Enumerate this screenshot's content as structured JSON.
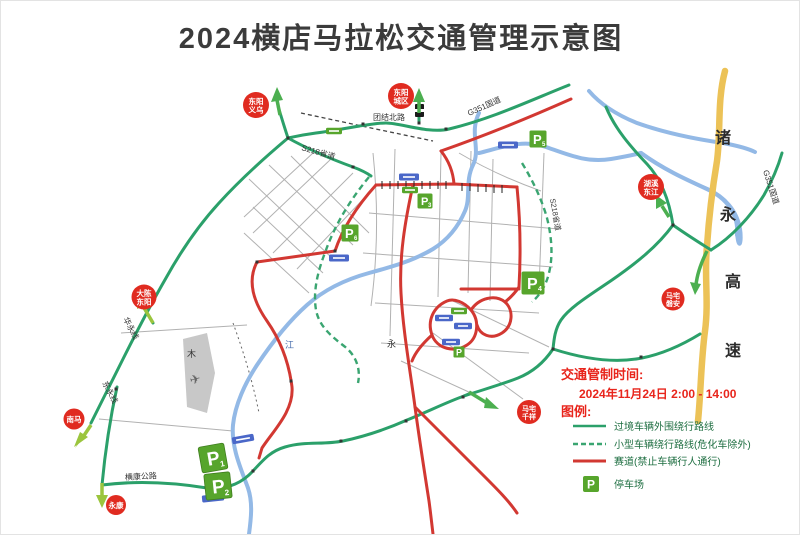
{
  "title": "2024横店马拉松交通管理示意图",
  "colors": {
    "bypass_green": "#2ba06a",
    "race_red": "#d23832",
    "river_blue": "#93b9e6",
    "expressway_yellow": "#ecc257",
    "badge_red": "#e02b20",
    "parking_green": "#57a52c",
    "legend_red": "#e8251c",
    "arrow_green": "#4caf50",
    "arrow_yellow_green": "#9bc53d"
  },
  "legend": {
    "control_time_label": "交通管制时间:",
    "control_time_value": "2024年11月24日 2:00 - 14:00",
    "legend_title": "图例:",
    "item_transit": "过境车辆外围绕行路线",
    "item_small_vehicle": "小型车辆绕行路线(危化车除外)",
    "item_race": "赛道(禁止车辆行人通行)",
    "item_parking": "停车场",
    "parking_symbol": "P"
  },
  "badges": {
    "dongyang_yiwu": {
      "line1": "东阳",
      "line2": "义乌"
    },
    "dongyang_chengqu": {
      "line1": "东阳",
      "line2": "城区"
    },
    "huxi_dongjiang": {
      "line1": "湖溪",
      "line2": "东江"
    },
    "mazhai_panan": {
      "line1": "马宅",
      "line2": "磐安"
    },
    "mazhai_qianxiang": {
      "line1": "马宅",
      "line2": "千祥"
    },
    "dachen_dongyang": {
      "line1": "大陈",
      "line2": "东阳"
    },
    "nanma": {
      "line1": "南马"
    },
    "yongkang": {
      "line1": "永康"
    }
  },
  "road_labels": {
    "g351_top": "G351国道",
    "g351_right": "G351国道",
    "s218_topleft": "S218省道",
    "s218_center": "S218省道",
    "tuanjie_north_road": "团结北路",
    "hengkang_highway": "横康公路",
    "huayong_line": "华永线",
    "dongyong_line": "东永线"
  },
  "expressway_label": {
    "char0": "诸",
    "char1": "永",
    "char2": "高",
    "char3": "速"
  },
  "parking_lots": {
    "p1": {
      "label": "P",
      "num": "1"
    },
    "p2": {
      "label": "P",
      "num": "2"
    },
    "p3": {
      "label": "P",
      "num": "3"
    },
    "p4": {
      "label": "P",
      "num": "4"
    },
    "p5": {
      "label": "P",
      "num": "5"
    },
    "p6": {
      "label": "P",
      "num": "6"
    },
    "p_small": {
      "label": "P",
      "num": ""
    }
  },
  "map_chars": {
    "mu": "木",
    "jiang": "江",
    "yong": "永"
  },
  "icons": {
    "airplane": "✈"
  }
}
